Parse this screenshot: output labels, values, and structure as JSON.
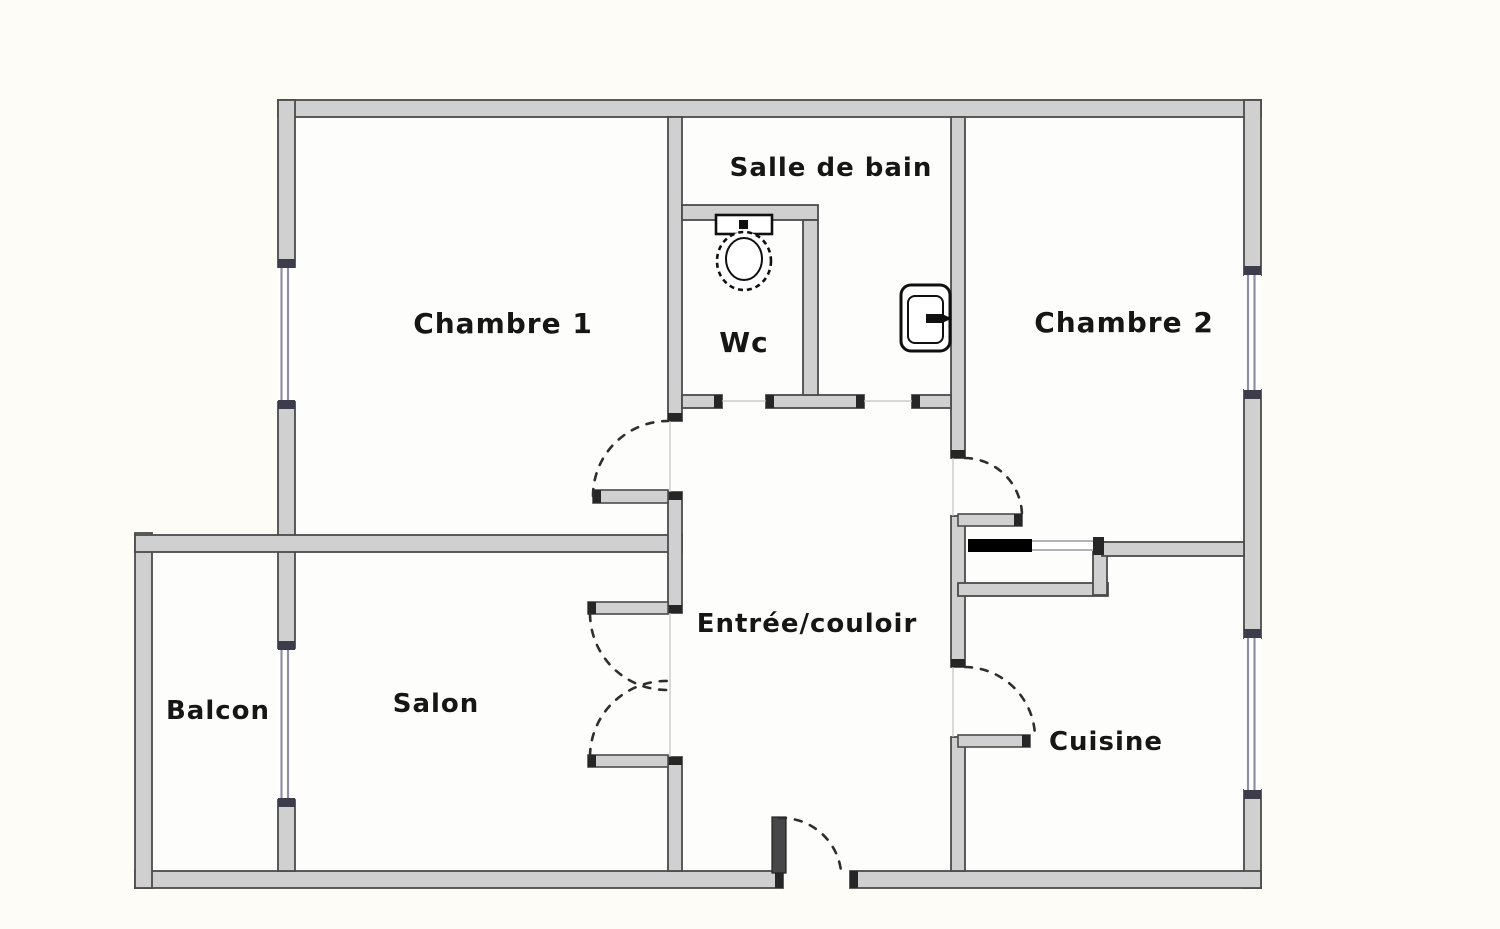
{
  "plan": {
    "type": "apartment-floor-plan",
    "rooms": [
      {
        "name": "chambre-1",
        "label": "Chambre 1"
      },
      {
        "name": "salle-de-bain",
        "label": "Salle de bain"
      },
      {
        "name": "wc",
        "label": "Wc"
      },
      {
        "name": "chambre-2",
        "label": "Chambre 2"
      },
      {
        "name": "entree-couloir",
        "label": "Entrée/couloir"
      },
      {
        "name": "salon",
        "label": "Salon"
      },
      {
        "name": "balcon",
        "label": "Balcon"
      },
      {
        "name": "cuisine",
        "label": "Cuisine"
      }
    ],
    "fixtures": [
      {
        "icon": "toilet-icon",
        "located_in": "Wc"
      },
      {
        "icon": "sink-icon",
        "located_in": "Salle de bain"
      }
    ],
    "features": {
      "windows_count": 4,
      "door_swing_arcs_count": 6,
      "double_door_room": "Salon"
    },
    "colors": {
      "page_background": "#fdfcf6",
      "room_background": "#fdfdfc",
      "wall_fill": "#d0d0d0",
      "wall_edge": "#4b4b4b",
      "cap": "#262626",
      "window_line": "#8f8fa3",
      "door_dash": "#2e2e2e",
      "label_text": "#161616",
      "closet_bar": "#000000",
      "entrance_door_leaf": "#474747"
    }
  }
}
